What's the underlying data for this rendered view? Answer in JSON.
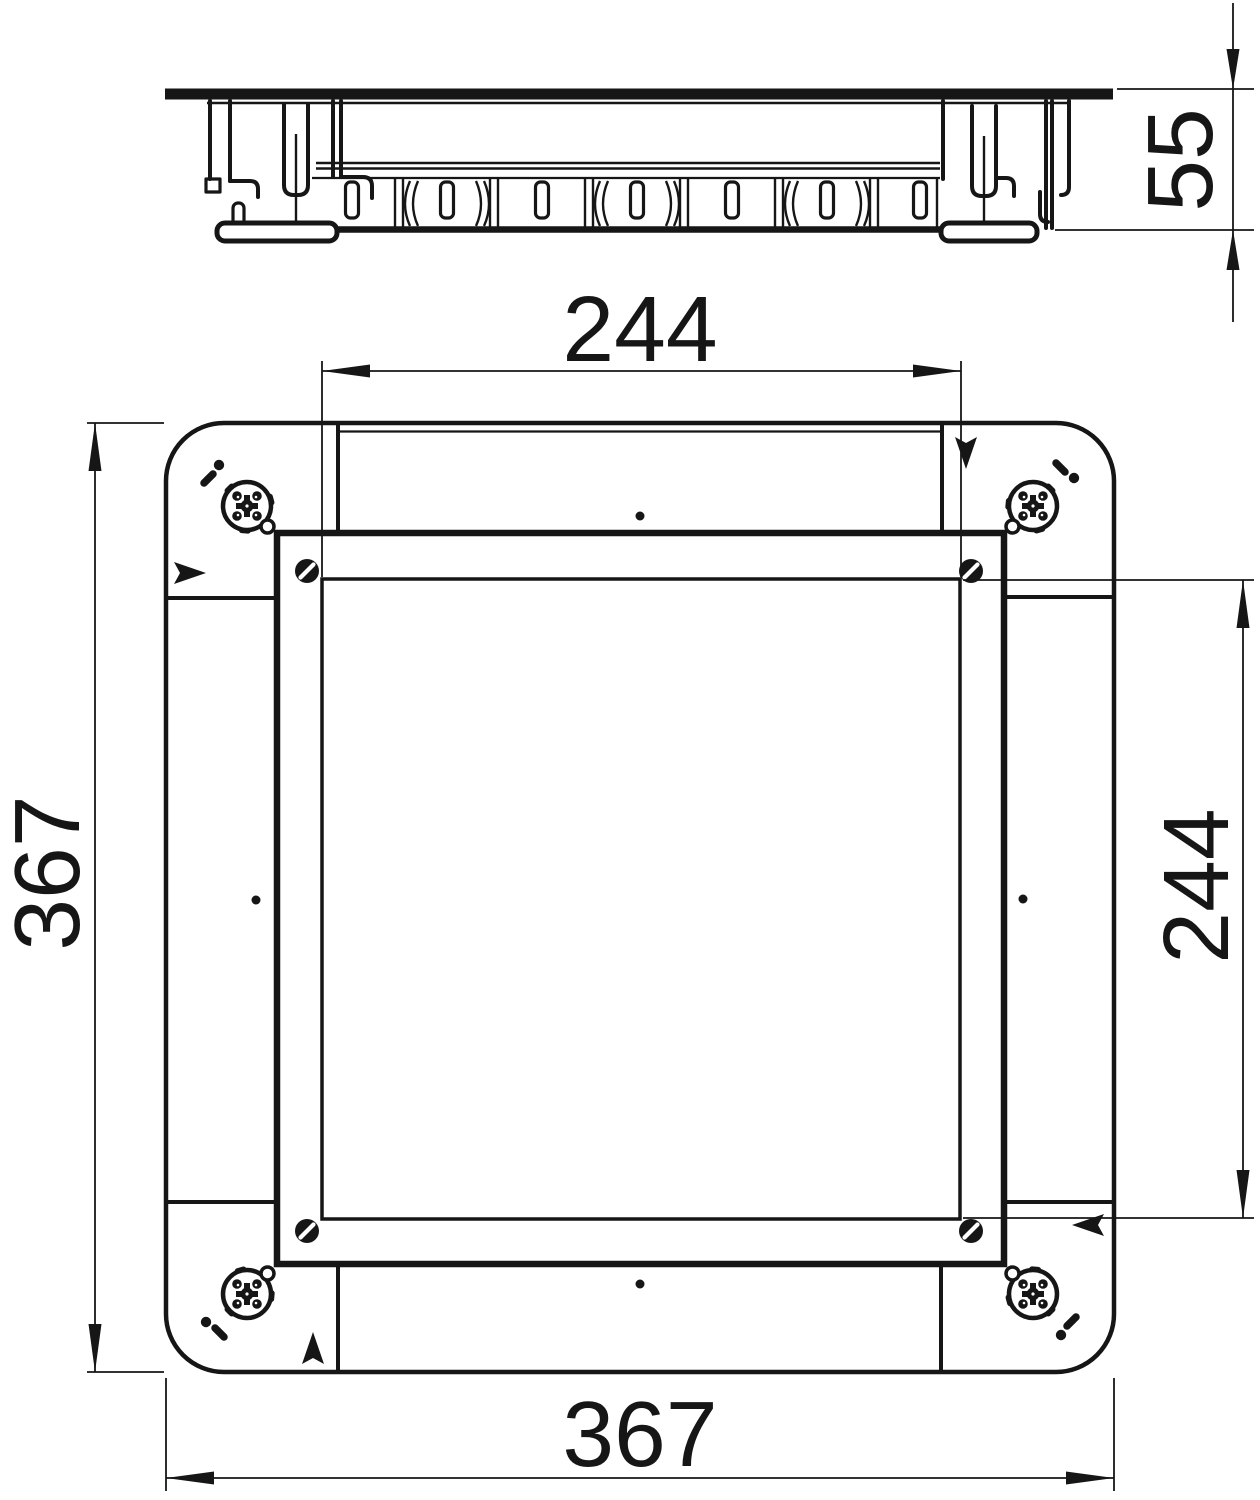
{
  "page": {
    "background": "#ffffff",
    "line_color": "#161616",
    "drawing_kind": "technical dimension drawing of a square floor-box / cassette unit"
  },
  "views": {
    "side_view": {
      "label": "side profile view"
    },
    "plan_view": {
      "label": "underside plan view"
    }
  },
  "dimensions": {
    "height": {
      "value": "55",
      "orientation": "vertical",
      "location": "side-view-right"
    },
    "inner_width": {
      "value": "244",
      "orientation": "horizontal",
      "location": "plan-top"
    },
    "inner_height": {
      "value": "244",
      "orientation": "vertical",
      "location": "plan-right"
    },
    "outer_height": {
      "value": "367",
      "orientation": "vertical",
      "location": "plan-left"
    },
    "outer_width": {
      "value": "367",
      "orientation": "horizontal",
      "location": "plan-bottom"
    }
  },
  "icons": {
    "fastener": "quarter-turn-fastener-icon",
    "screw": "slotted-screw-icon",
    "arrow": "orientation-arrow",
    "center_mark": "center-mark-dot"
  }
}
